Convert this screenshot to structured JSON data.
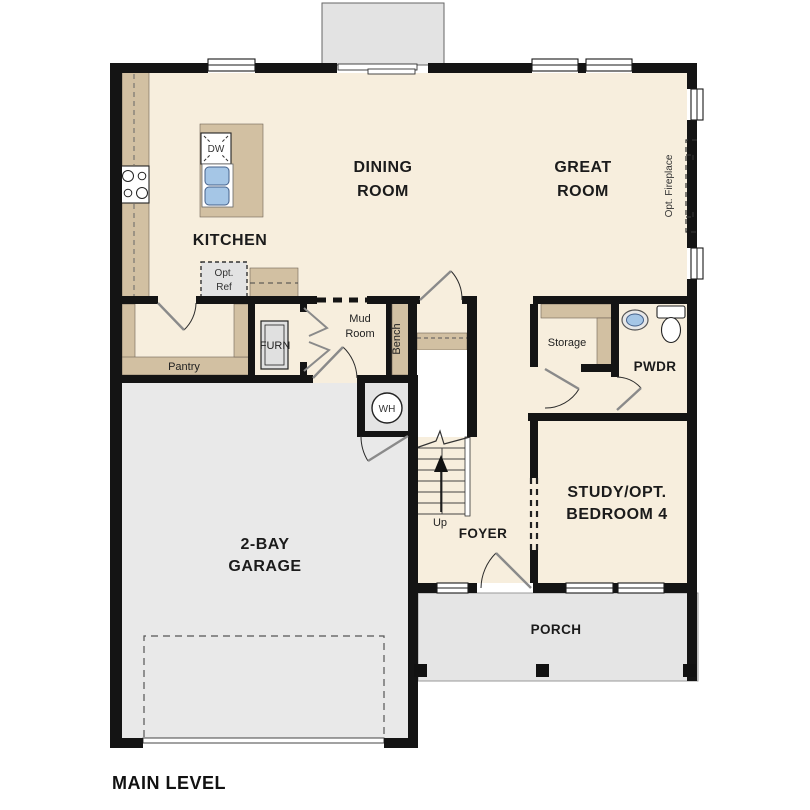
{
  "title": "MAIN LEVEL",
  "labels": {
    "main_level": "MAIN LEVEL",
    "kitchen": "KITCHEN",
    "dining_1": "DINING",
    "dining_2": "ROOM",
    "great_1": "GREAT",
    "great_2": "ROOM",
    "study_1": "STUDY/OPT.",
    "study_2": "BEDROOM 4",
    "garage_1": "2-BAY",
    "garage_2": "GARAGE",
    "foyer": "FOYER",
    "porch": "PORCH",
    "pwdr": "PWDR",
    "mud_1": "Mud",
    "mud_2": "Room",
    "pantry": "Pantry",
    "storage": "Storage",
    "bench": "Bench",
    "furn": "FURN",
    "wh": "WH",
    "up": "Up",
    "dw": "DW",
    "opt_ref_1": "Opt.",
    "opt_ref_2": "Ref",
    "opt_fireplace": "Opt. Fireplace"
  },
  "colors": {
    "floor": "#f7eedd",
    "wall": "#141414",
    "counter_tan": "#d2c0a2",
    "garage_floor": "#e9e9e9",
    "porch_floor": "#e5e5e5",
    "patio_gray": "#e3e3e3",
    "sink_blue": "#a5c6e6",
    "optional_fill": "#e3e3e3",
    "closet_white": "#ffffff"
  }
}
